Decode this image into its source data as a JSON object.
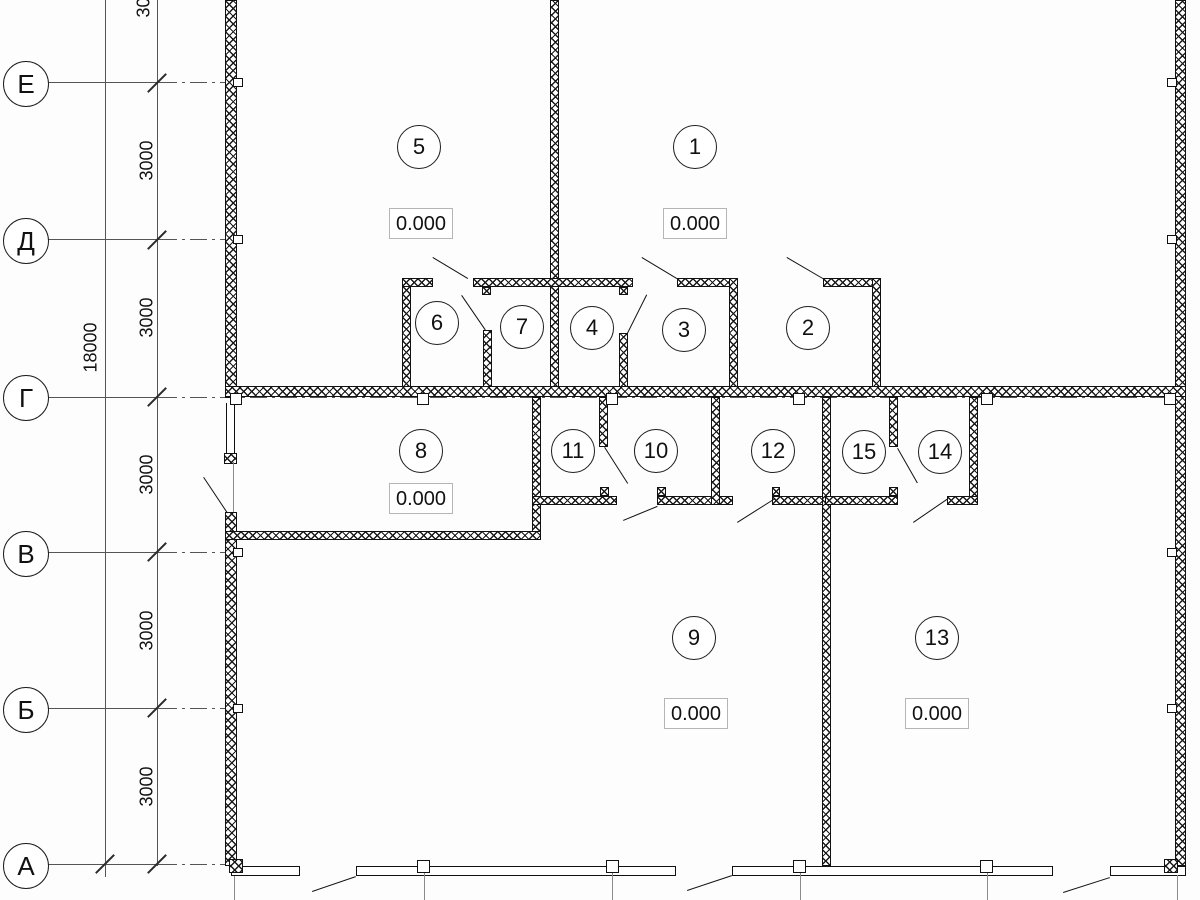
{
  "drawing_type": "floor-plan",
  "axes": [
    {
      "label": "Е"
    },
    {
      "label": "Д"
    },
    {
      "label": "Г"
    },
    {
      "label": "В"
    },
    {
      "label": "Б"
    },
    {
      "label": "А"
    }
  ],
  "dimensions": {
    "total": "18000",
    "segments": [
      "3000",
      "3000",
      "3000",
      "3000",
      "3000",
      "3000"
    ]
  },
  "rooms": {
    "1": {
      "number": "1",
      "elevation": "0.000"
    },
    "2": {
      "number": "2"
    },
    "3": {
      "number": "3"
    },
    "4": {
      "number": "4"
    },
    "5": {
      "number": "5",
      "elevation": "0.000"
    },
    "6": {
      "number": "6"
    },
    "7": {
      "number": "7"
    },
    "8": {
      "number": "8",
      "elevation": "0.000"
    },
    "9": {
      "number": "9",
      "elevation": "0.000"
    },
    "10": {
      "number": "10"
    },
    "11": {
      "number": "11"
    },
    "12": {
      "number": "12"
    },
    "13": {
      "number": "13",
      "elevation": "0.000"
    },
    "14": {
      "number": "14"
    },
    "15": {
      "number": "15"
    }
  }
}
